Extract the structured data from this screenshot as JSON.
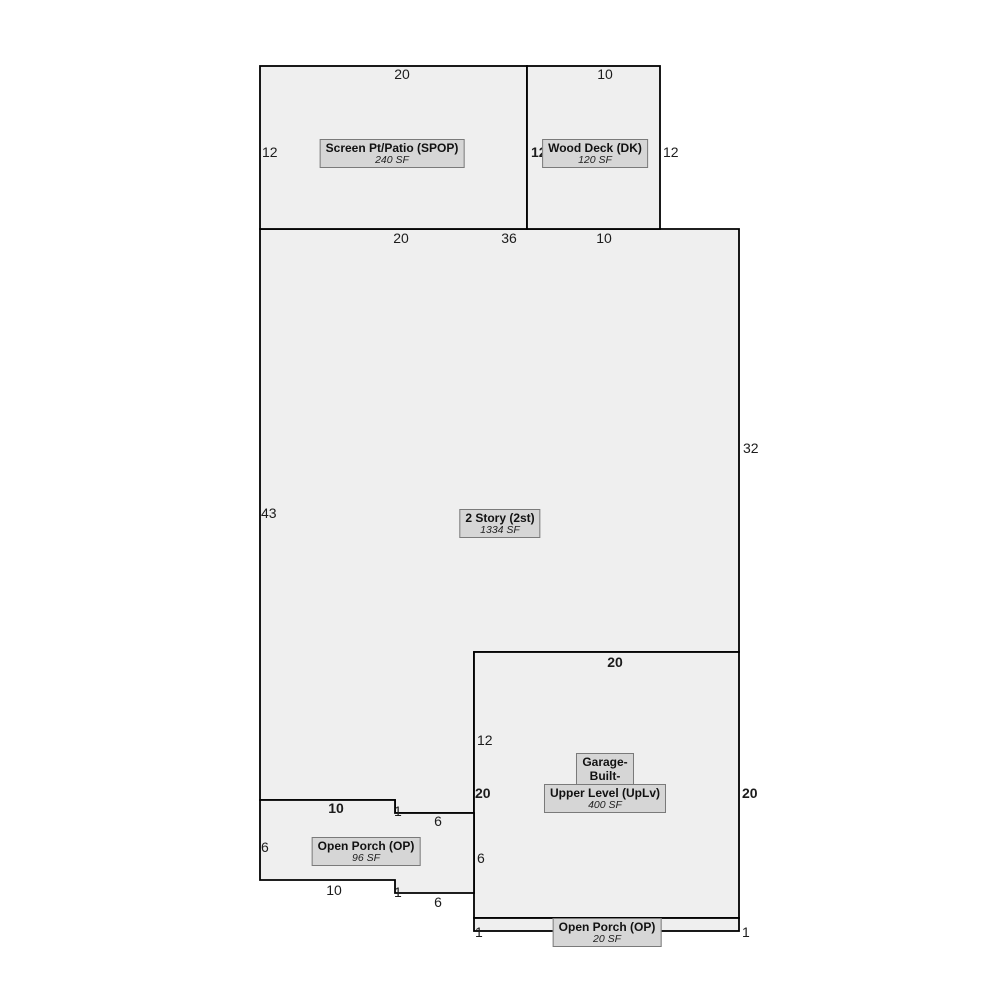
{
  "sketch": {
    "areas": {
      "spop": {
        "title": "Screen Pt/Patio (SPOP)",
        "sf": "240 SF"
      },
      "dk": {
        "title": "Wood Deck (DK)",
        "sf": "120 SF"
      },
      "story2": {
        "title": "2 Story (2st)",
        "sf": "1334 SF"
      },
      "garage": {
        "title_line1": "Garage-",
        "title_line2": "Built-",
        "title_line3": "Upper Level (UpLv)",
        "sf": "400 SF"
      },
      "op96": {
        "title": "Open Porch (OP)",
        "sf": "96 SF"
      },
      "op20": {
        "title": "Open Porch (OP)",
        "sf": "20 SF"
      }
    },
    "dims": {
      "spop_top": "20",
      "spop_left": "12",
      "spop_bottom": "20",
      "dk_top": "10",
      "dk_left": "12",
      "dk_right": "12",
      "dk_bottom": "10",
      "story2_top": "36",
      "story2_left": "43",
      "story2_right": "32",
      "garage_top": "20",
      "garage_left_upper": "12",
      "garage_left": "20",
      "garage_left_lower": "6",
      "garage_right": "20",
      "op96_top": "10",
      "op96_top_step": "1",
      "op96_top_right": "6",
      "op96_left": "6",
      "op96_bottom": "10",
      "op96_bottom_step": "1",
      "op96_bottom_right": "6",
      "op20_left": "1",
      "op20_right": "1",
      "op20_bottom": "20"
    },
    "colors": {
      "region_fill": "#efefef",
      "outline": "#000000",
      "label_bg": "#d6d6d6",
      "label_border": "#7a7a7a"
    }
  }
}
